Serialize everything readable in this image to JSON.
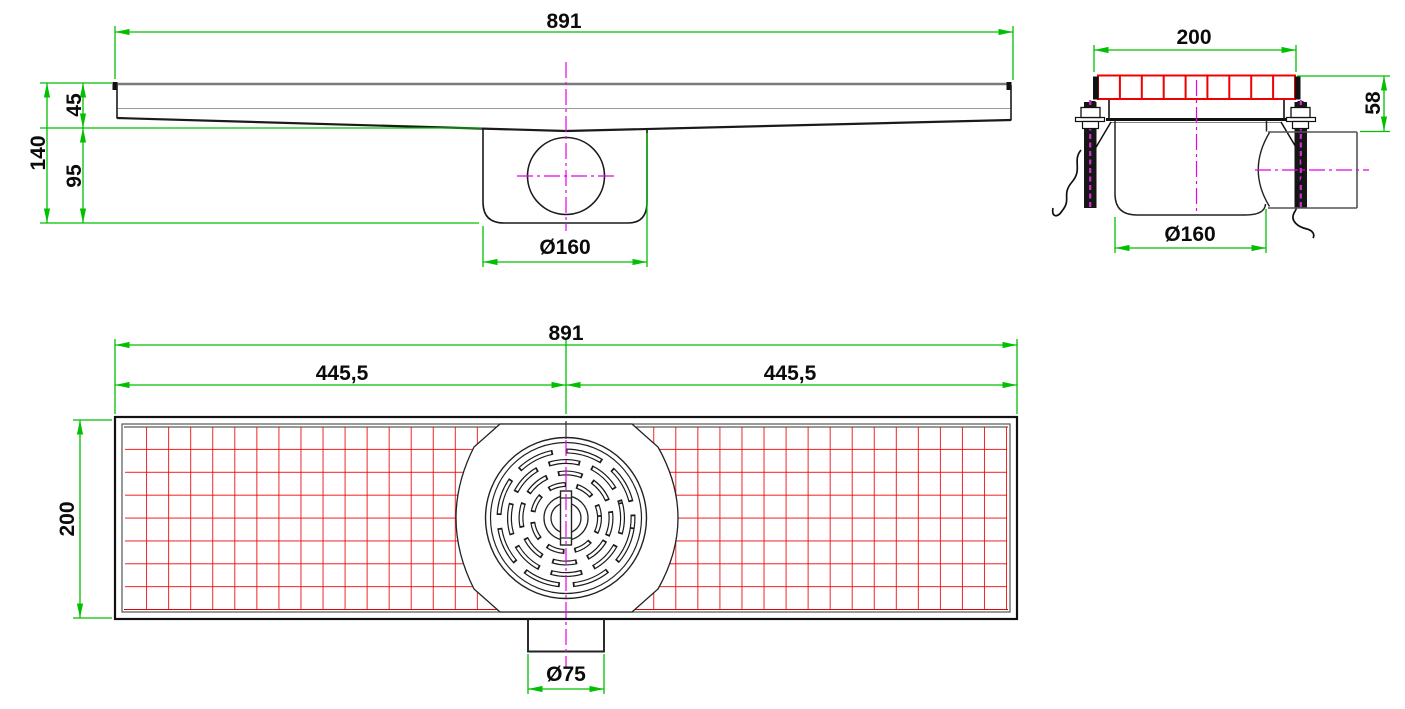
{
  "colors": {
    "dimension_green": "#00c000",
    "grate_red": "#f00000",
    "centerline_magenta": "#e800e8",
    "outline_black": "#1a1a1a",
    "steel_gray": "#7a7a7a"
  },
  "side_view": {
    "length": "891",
    "rim_height": "45",
    "sump_height": "95",
    "total_height": "140",
    "sump_diameter": "Ø160"
  },
  "end_view": {
    "width": "200",
    "edge_height": "58",
    "sump_diameter": "Ø160"
  },
  "plan_view": {
    "length": "891",
    "left_half": "445,5",
    "right_half": "445,5",
    "width": "200",
    "outlet_diameter": "Ø75"
  }
}
